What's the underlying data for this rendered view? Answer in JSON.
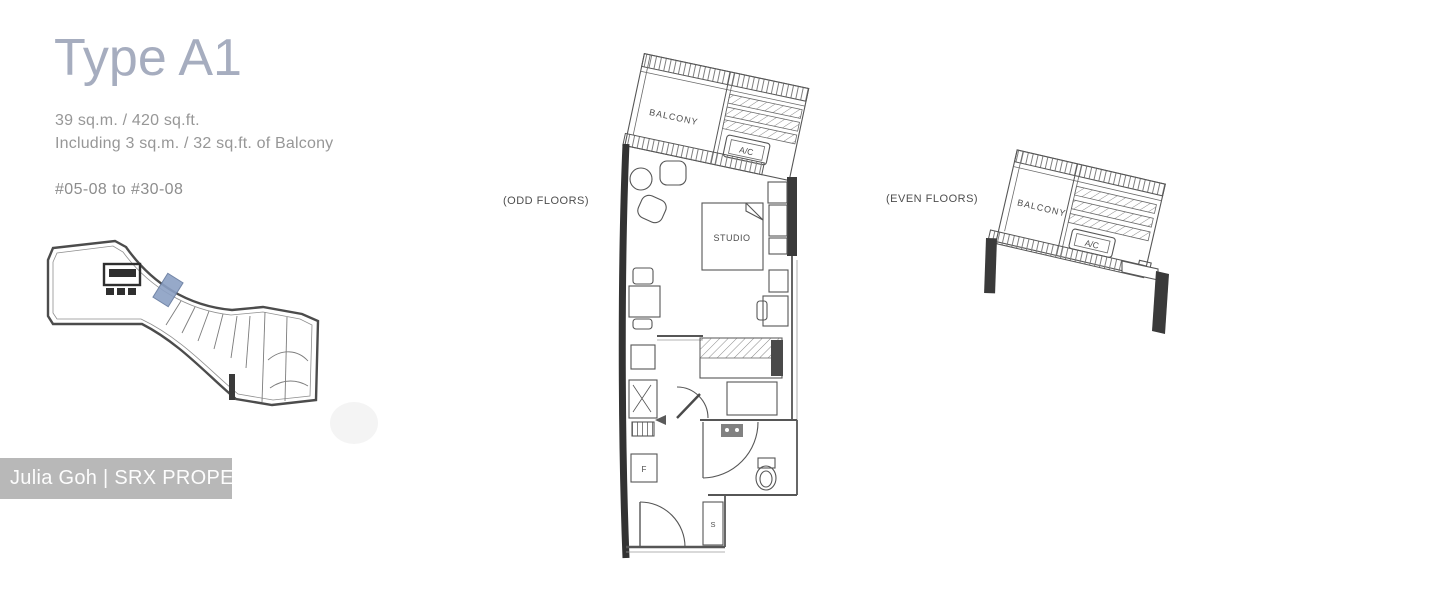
{
  "header": {
    "title": "Type A1",
    "area_line1": "39 sq.m. / 420 sq.ft.",
    "area_line2": "Including 3 sq.m. / 32 sq.ft. of Balcony",
    "unit_range": "#05-08 to #30-08"
  },
  "odd_plan": {
    "caption": "(ODD FLOORS)",
    "labels": {
      "balcony": "BALCONY",
      "ac": "A/C",
      "studio": "STUDIO",
      "fridge": "F",
      "shoe_cabinet": "S"
    }
  },
  "even_plan": {
    "caption": "(EVEN FLOORS)",
    "labels": {
      "balcony": "BALCONY",
      "ac": "A/C"
    }
  },
  "watermark": {
    "text": "Julia Goh | SRX PROPERTY"
  },
  "colors": {
    "title_text": "#a6adbf",
    "body_text": "#979797",
    "plan_line": "#565656",
    "thick_wall": "#383838",
    "key_plan_highlight": "#8ba0c4",
    "watermark_bg": "#b8b8b8",
    "watermark_text": "#fdfdfd",
    "background": "#ffffff"
  }
}
